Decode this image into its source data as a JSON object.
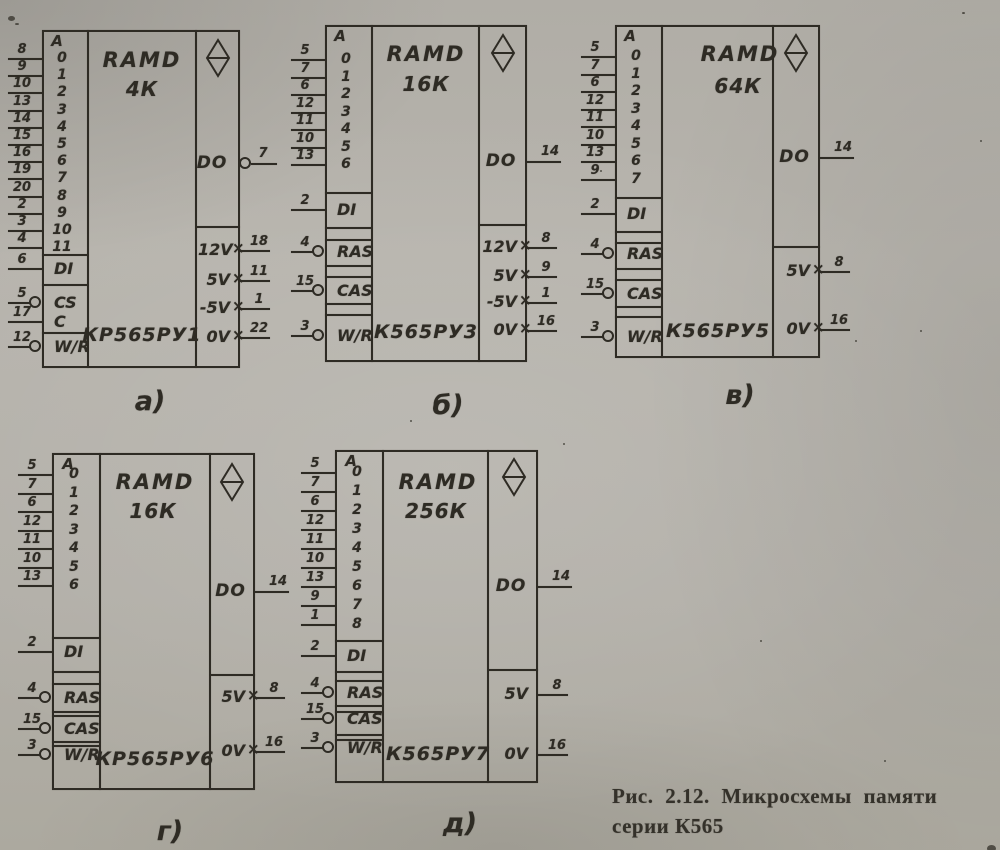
{
  "figure": {
    "caption_line1": "Рис. 2.12. Микросхемы памяти",
    "caption_line2": "серии К565"
  },
  "symbols": {
    "address_header": "A",
    "bidirectional_icon": "diamond-with-bar"
  },
  "chips": [
    {
      "id": "a",
      "label": "а)",
      "family": "RAMD",
      "capacity": "4К",
      "part": "КР565РУ1",
      "address_pins": [
        {
          "bit": "0",
          "pin": "8"
        },
        {
          "bit": "1",
          "pin": "9"
        },
        {
          "bit": "2",
          "pin": "10"
        },
        {
          "bit": "3",
          "pin": "13"
        },
        {
          "bit": "4",
          "pin": "14"
        },
        {
          "bit": "5",
          "pin": "15"
        },
        {
          "bit": "6",
          "pin": "16"
        },
        {
          "bit": "7",
          "pin": "19"
        },
        {
          "bit": "8",
          "pin": "20"
        },
        {
          "bit": "9",
          "pin": "2"
        },
        {
          "bit": "10",
          "pin": "3"
        },
        {
          "bit": "11",
          "pin": "4"
        }
      ],
      "control_pins": [
        {
          "label": "DI",
          "pin": "6",
          "inverted": false
        },
        {
          "label": "CS",
          "pin": "5",
          "inverted": true
        },
        {
          "label": "C",
          "pin": "17",
          "inverted": false
        },
        {
          "label": "W/R",
          "pin": "12",
          "inverted": true
        }
      ],
      "output_pin": {
        "label": "DO",
        "pin": "7",
        "inverted": true
      },
      "power_pins": [
        {
          "label": "12V",
          "pin": "18",
          "cross": true
        },
        {
          "label": "5V",
          "pin": "11",
          "cross": true
        },
        {
          "label": "-5V",
          "pin": "1",
          "cross": true
        },
        {
          "label": "0V",
          "pin": "22",
          "cross": true
        }
      ]
    },
    {
      "id": "b",
      "label": "б)",
      "family": "RAMD",
      "capacity": "16К",
      "part": "К565РУ3",
      "address_pins": [
        {
          "bit": "0",
          "pin": "5"
        },
        {
          "bit": "1",
          "pin": "7"
        },
        {
          "bit": "2",
          "pin": "6"
        },
        {
          "bit": "3",
          "pin": "12"
        },
        {
          "bit": "4",
          "pin": "11"
        },
        {
          "bit": "5",
          "pin": "10"
        },
        {
          "bit": "6",
          "pin": "13"
        }
      ],
      "control_pins": [
        {
          "label": "DI",
          "pin": "2",
          "inverted": false
        },
        {
          "label": "RAS",
          "pin": "4",
          "inverted": true
        },
        {
          "label": "CAS",
          "pin": "15",
          "inverted": true
        },
        {
          "label": "W/R",
          "pin": "3",
          "inverted": true
        }
      ],
      "output_pin": {
        "label": "DO",
        "pin": "14",
        "inverted": false
      },
      "power_pins": [
        {
          "label": "12V",
          "pin": "8",
          "cross": true
        },
        {
          "label": "5V",
          "pin": "9",
          "cross": true
        },
        {
          "label": "-5V",
          "pin": "1",
          "cross": true
        },
        {
          "label": "0V",
          "pin": "16",
          "cross": true
        }
      ]
    },
    {
      "id": "v",
      "label": "в)",
      "family": "RAMD",
      "capacity": "64К",
      "part": "К565РУ5",
      "address_pins": [
        {
          "bit": "0",
          "pin": "5"
        },
        {
          "bit": "1",
          "pin": "7"
        },
        {
          "bit": "2",
          "pin": "6"
        },
        {
          "bit": "3",
          "pin": "12"
        },
        {
          "bit": "4",
          "pin": "11"
        },
        {
          "bit": "5",
          "pin": "10"
        },
        {
          "bit": "6",
          "pin": "13"
        },
        {
          "bit": "7",
          "pin": "9"
        }
      ],
      "control_pins": [
        {
          "label": "DI",
          "pin": "2",
          "inverted": false
        },
        {
          "label": "RAS",
          "pin": "4",
          "inverted": true
        },
        {
          "label": "CAS",
          "pin": "15",
          "inverted": true
        },
        {
          "label": "W/R",
          "pin": "3",
          "inverted": true
        }
      ],
      "output_pin": {
        "label": "DO",
        "pin": "14",
        "inverted": false
      },
      "power_pins": [
        {
          "label": "5V",
          "pin": "8",
          "cross": true
        },
        {
          "label": "0V",
          "pin": "16",
          "cross": true
        }
      ]
    },
    {
      "id": "g",
      "label": "г)",
      "family": "RAMD",
      "capacity": "16К",
      "part": "КР565РУ6",
      "address_pins": [
        {
          "bit": "0",
          "pin": "5"
        },
        {
          "bit": "1",
          "pin": "7"
        },
        {
          "bit": "2",
          "pin": "6"
        },
        {
          "bit": "3",
          "pin": "12"
        },
        {
          "bit": "4",
          "pin": "11"
        },
        {
          "bit": "5",
          "pin": "10"
        },
        {
          "bit": "6",
          "pin": "13"
        }
      ],
      "control_pins": [
        {
          "label": "DI",
          "pin": "2",
          "inverted": false
        },
        {
          "label": "RAS",
          "pin": "4",
          "inverted": true
        },
        {
          "label": "CAS",
          "pin": "15",
          "inverted": true
        },
        {
          "label": "W/R",
          "pin": "3",
          "inverted": true
        }
      ],
      "output_pin": {
        "label": "DO",
        "pin": "14",
        "inverted": false
      },
      "power_pins": [
        {
          "label": "5V",
          "pin": "8",
          "cross": true
        },
        {
          "label": "0V",
          "pin": "16",
          "cross": true
        }
      ]
    },
    {
      "id": "d",
      "label": "д)",
      "family": "RAMD",
      "capacity": "256К",
      "part": "К565РУ7",
      "address_pins": [
        {
          "bit": "0",
          "pin": "5"
        },
        {
          "bit": "1",
          "pin": "7"
        },
        {
          "bit": "2",
          "pin": "6"
        },
        {
          "bit": "3",
          "pin": "12"
        },
        {
          "bit": "4",
          "pin": "11"
        },
        {
          "bit": "5",
          "pin": "10"
        },
        {
          "bit": "6",
          "pin": "13"
        },
        {
          "bit": "7",
          "pin": "9"
        },
        {
          "bit": "8",
          "pin": "1"
        }
      ],
      "control_pins": [
        {
          "label": "DI",
          "pin": "2",
          "inverted": false
        },
        {
          "label": "RAS",
          "pin": "4",
          "inverted": true
        },
        {
          "label": "CAS",
          "pin": "15",
          "inverted": true
        },
        {
          "label": "W/R",
          "pin": "3",
          "inverted": true
        }
      ],
      "output_pin": {
        "label": "DO",
        "pin": "14",
        "inverted": false
      },
      "power_pins": [
        {
          "label": "5V",
          "pin": "8",
          "cross": false
        },
        {
          "label": "0V",
          "pin": "16",
          "cross": false
        }
      ]
    }
  ]
}
